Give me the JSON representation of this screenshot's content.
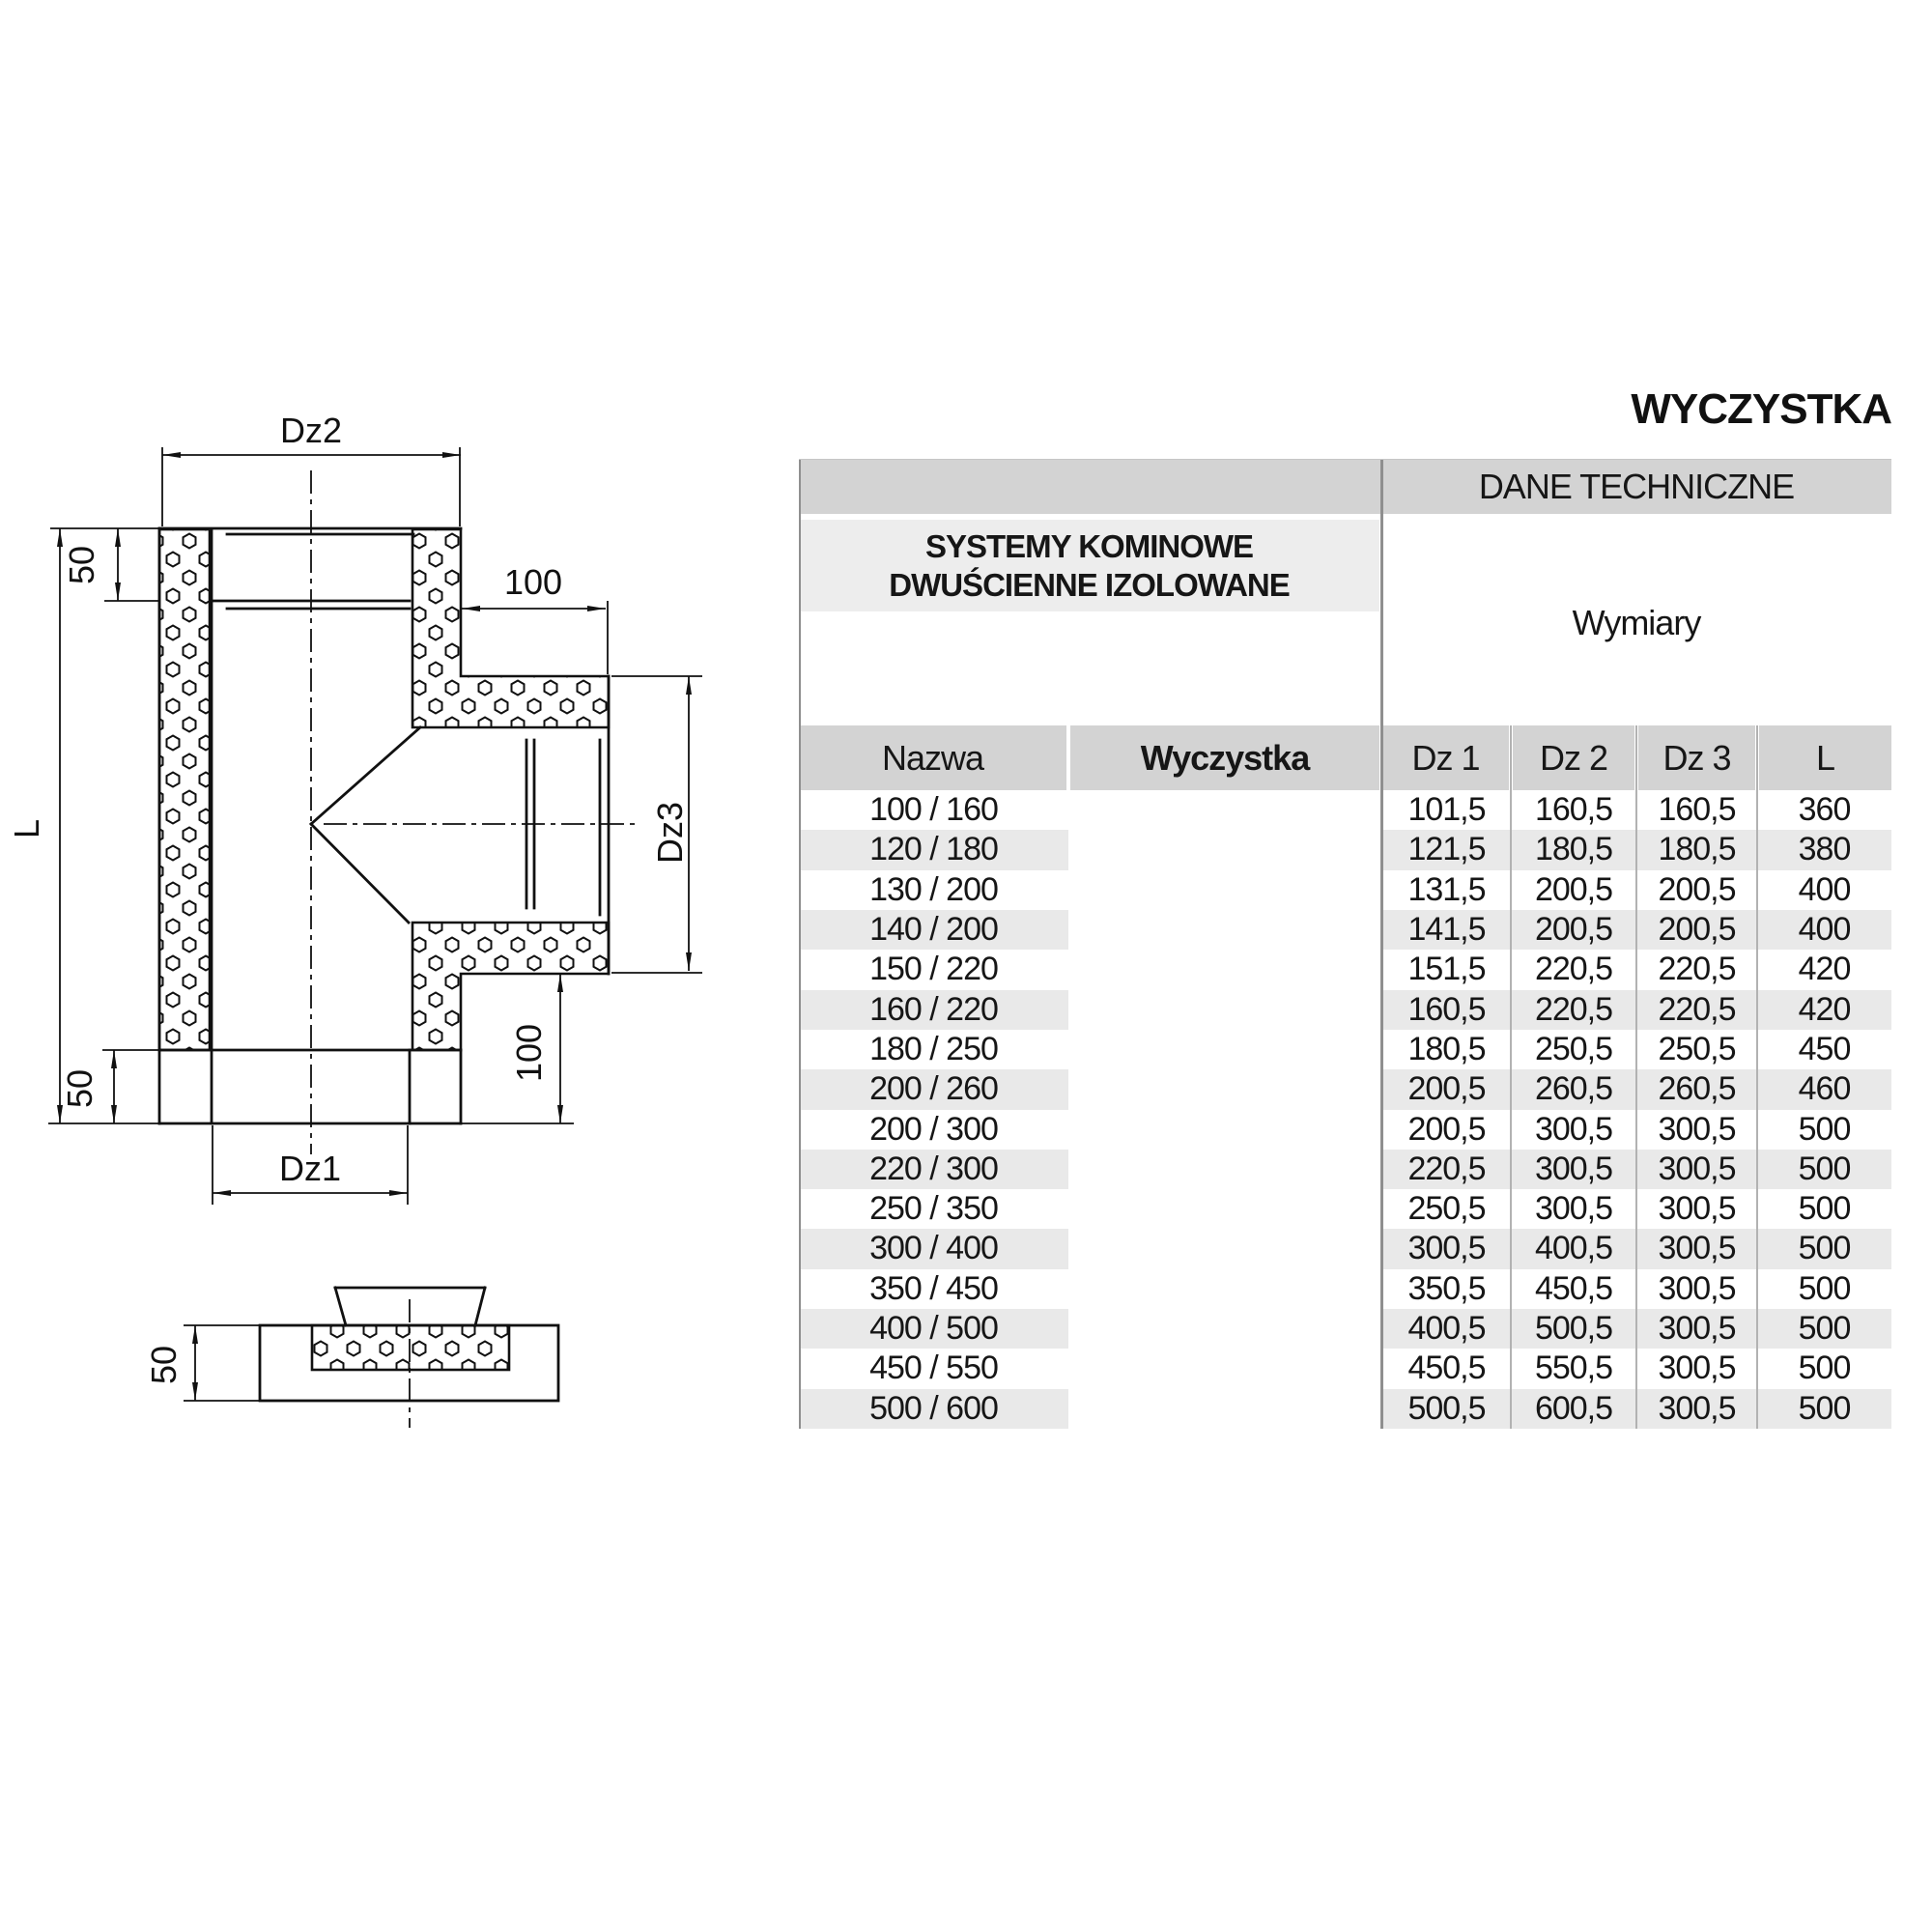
{
  "title": "WYCZYSTKA",
  "table": {
    "header": "DANE TECHNICZNE",
    "section_title_line1": "SYSTEMY KOMINOWE",
    "section_title_line2": "DWUŚCIENNE IZOLOWANE",
    "group_header": "Wymiary",
    "columns": [
      "Nazwa",
      "Wyczystka",
      "Dz 1",
      "Dz 2",
      "Dz 3",
      "L"
    ],
    "rows": [
      [
        "100 / 160",
        "101,5",
        "160,5",
        "160,5",
        "360"
      ],
      [
        "120 / 180",
        "121,5",
        "180,5",
        "180,5",
        "380"
      ],
      [
        "130 / 200",
        "131,5",
        "200,5",
        "200,5",
        "400"
      ],
      [
        "140 / 200",
        "141,5",
        "200,5",
        "200,5",
        "400"
      ],
      [
        "150 / 220",
        "151,5",
        "220,5",
        "220,5",
        "420"
      ],
      [
        "160 / 220",
        "160,5",
        "220,5",
        "220,5",
        "420"
      ],
      [
        "180 / 250",
        "180,5",
        "250,5",
        "250,5",
        "450"
      ],
      [
        "200 / 260",
        "200,5",
        "260,5",
        "260,5",
        "460"
      ],
      [
        "200 / 300",
        "200,5",
        "300,5",
        "300,5",
        "500"
      ],
      [
        "220 / 300",
        "220,5",
        "300,5",
        "300,5",
        "500"
      ],
      [
        "250 / 350",
        "250,5",
        "300,5",
        "300,5",
        "500"
      ],
      [
        "300 / 400",
        "300,5",
        "400,5",
        "300,5",
        "500"
      ],
      [
        "350 / 450",
        "350,5",
        "450,5",
        "300,5",
        "500"
      ],
      [
        "400 / 500",
        "400,5",
        "500,5",
        "300,5",
        "500"
      ],
      [
        "450 / 550",
        "450,5",
        "550,5",
        "300,5",
        "500"
      ],
      [
        "500 / 600",
        "500,5",
        "600,5",
        "300,5",
        "500"
      ]
    ]
  },
  "diagram": {
    "labels": {
      "dz1": "Dz1",
      "dz2": "Dz2",
      "dz3": "Dz3",
      "l": "L",
      "len100": "100",
      "len50": "50"
    }
  },
  "colors": {
    "header_gray": "#d3d3d3",
    "section_gray": "#ededed",
    "stripe_gray": "#e9e9e9",
    "divider_dark": "#8f8f8f",
    "divider_light": "#b2b2b2",
    "line_black": "#111111"
  }
}
